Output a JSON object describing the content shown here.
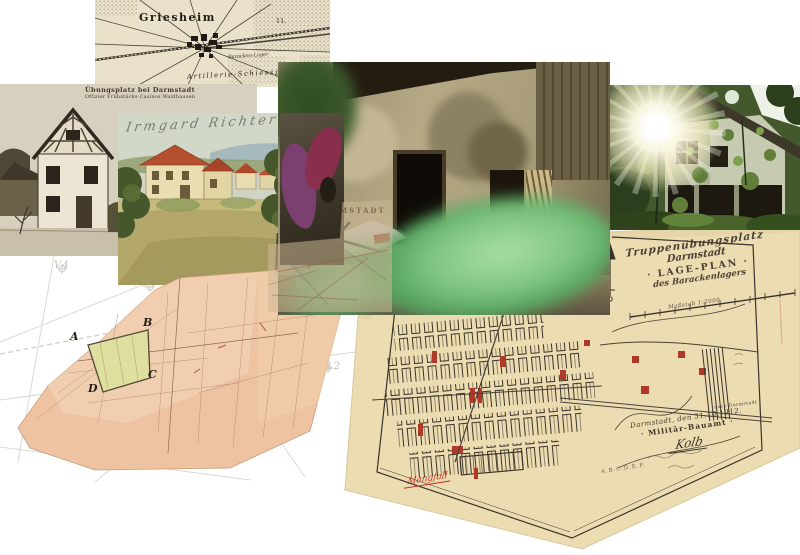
{
  "top_map": {
    "town_label": "Griesheim",
    "barracks_label": "Baracken-Lager",
    "artillery_label": "Artillerie-Schiessplatz",
    "grid_label": "11."
  },
  "bw_postcard": {
    "caption_line1": "Übungsplatz bei Darmstadt",
    "caption_line2": "Offizier Frühstücks-Casinos Waldhausen"
  },
  "color_postcard": {
    "handwriting": "Irmgard Richter"
  },
  "map_fragment": {
    "watermark": "DARMSTADT"
  },
  "faint_map": {
    "labels": [
      "V4",
      "V3",
      "V12",
      "V10",
      "V11"
    ]
  },
  "strip_map": {
    "corner_labels": [
      "A",
      "B",
      "C",
      "D"
    ]
  },
  "plan": {
    "title_line1": "Truppenübungsplatz",
    "title_line2": "Darmstadt",
    "title_line3": "· LAGE-PLAN ·",
    "title_line4": "des Barackenlagers",
    "scale_label": "Maßstab 1:2000",
    "road_label": "nach Darmstadt",
    "date_line": "Darmstadt, den 31.10.1912.",
    "office_line": "· Militär-Bauamt ·",
    "signature": "Kolb",
    "red_note": "Mangfall",
    "pencil_note": "A.B.C.D.E.F."
  },
  "colors": {
    "map_paper": "#e9e1c9",
    "plan_paper": "#ecdcb2",
    "plan_ink": "#3a332a",
    "plan_red": "#b03a2a",
    "strip_pink": "#eec3a2",
    "parcel_green": "#dfdf9f",
    "leaf_green": "#7cc47e",
    "roof_red": "#b5502f"
  }
}
